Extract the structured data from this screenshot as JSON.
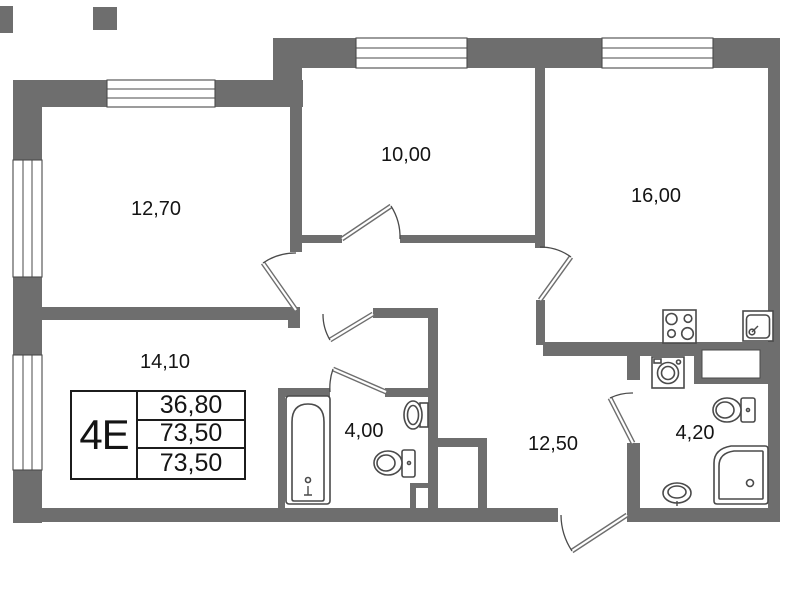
{
  "plan": {
    "unit_type_label": "4Е",
    "areas_table": {
      "rows": [
        "36,80",
        "73,50",
        "73,50"
      ]
    },
    "room_labels": {
      "room_top_left": "12,70",
      "room_top_middle": "10,00",
      "room_top_right": "16,00",
      "room_bottom_left": "14,10",
      "bathroom": "4,00",
      "hallway": "12,50",
      "wc": "4,20"
    },
    "fixtures": [
      "bathtub",
      "toilet",
      "wash-basin",
      "corner-shower",
      "washing-machine",
      "stove",
      "kitchen-sink"
    ],
    "colors": {
      "wall": "#6e6e6e",
      "line": "#4a4a4a",
      "text": "#141414",
      "bg": "#ffffff"
    }
  }
}
